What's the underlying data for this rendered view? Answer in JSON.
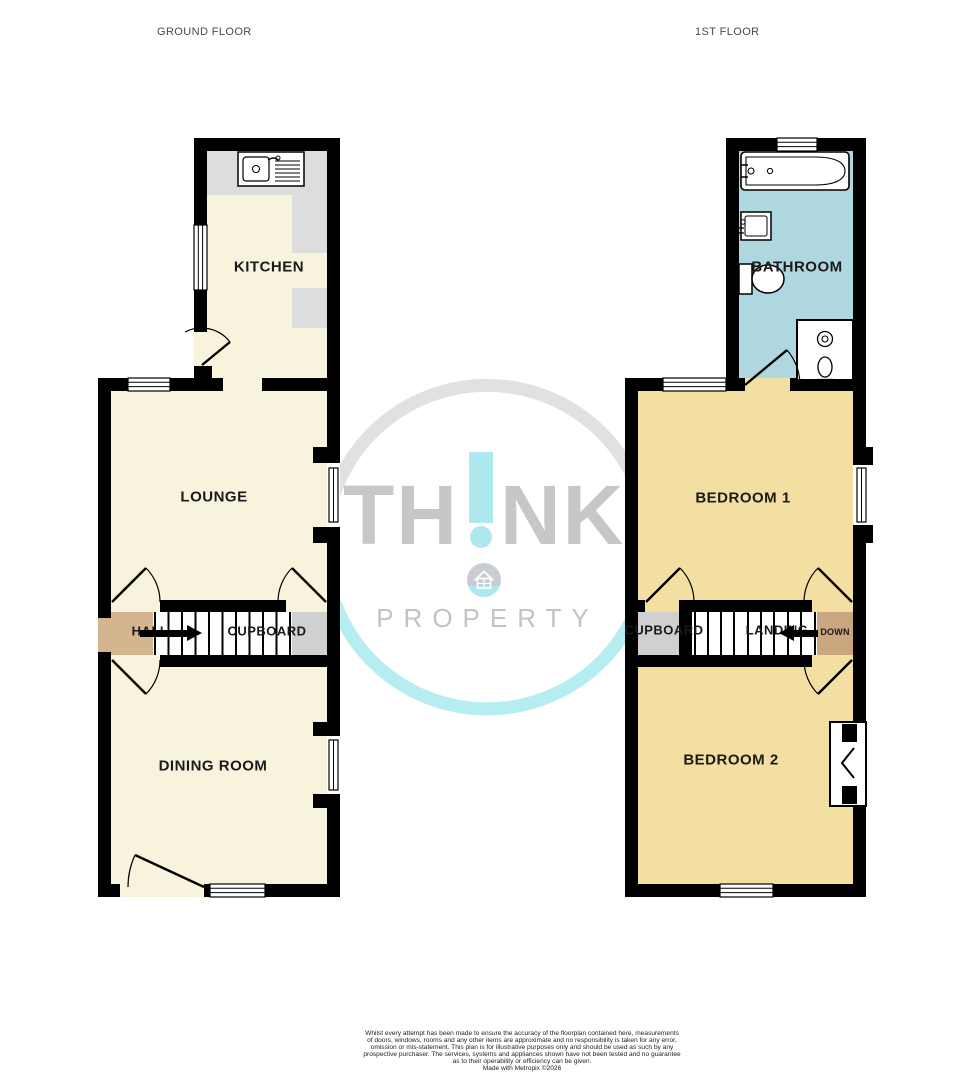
{
  "headers": {
    "ground_floor": "GROUND FLOOR",
    "first_floor": "1ST FLOOR"
  },
  "rooms": {
    "kitchen": "KITCHEN",
    "lounge": "LOUNGE",
    "hall": "HALL",
    "cupboard_ground": "CUPBOARD",
    "dining_room": "DINING ROOM",
    "bathroom": "BATHROOM",
    "bedroom1": "BEDROOM 1",
    "cupboard_first": "CUPBOARD",
    "landing": "LANDING",
    "down": "DOWN",
    "bedroom2": "BEDROOM 2"
  },
  "watermark": {
    "word_part1": "TH",
    "word_part2": "NK",
    "word_sub": "PROPERTY"
  },
  "disclaimer": {
    "lines": [
      "Whilst every attempt has been made to ensure the accuracy of the floorplan contained here, measurements",
      "of doors, windows, rooms and any other items are approximate and no responsibility is taken for any error,",
      "omission or mis-statement. This plan is for illustrative purposes only and should be used as such by any",
      "prospective purchaser. The services, systems and appliances shown have not been tested and no guarantee",
      "as to their operability or efficiency can be given.",
      "Made with Metropix ©2026"
    ]
  },
  "colors": {
    "wall": "#000000",
    "floor_cream": "#f8f3dc",
    "floor_yellow": "#f2dfa1",
    "floor_blue": "#afd7e0",
    "hall_tan": "#d5b58f",
    "down_tan": "#c9a67e",
    "cupboard_gray": "#d0d0d0",
    "counter_gray": "#dddddd",
    "ring_gray": "#e1e1e1",
    "ring_cyan": "#b6edf1",
    "brand_gray": "#c7c7c7",
    "brand_cyan": "#aee9ee"
  }
}
